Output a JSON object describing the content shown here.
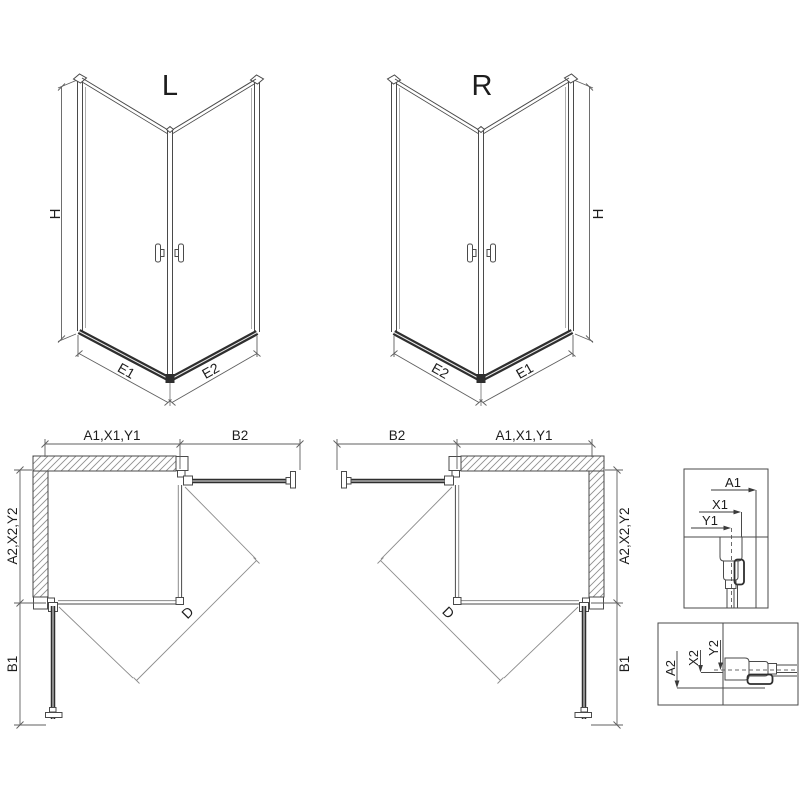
{
  "diagram": {
    "iso_left": {
      "title": "L",
      "h": "H",
      "e1": "E1",
      "e2": "E2"
    },
    "iso_right": {
      "title": "R",
      "h": "H",
      "e1": "E1",
      "e2": "E2"
    },
    "plan_left": {
      "width_label": "A1,X1,Y1",
      "door_top_label": "B2",
      "depth_label": "A2,X2,Y2",
      "door_side_label": "B1",
      "diagonal_label": "D"
    },
    "plan_right": {
      "width_label": "A1,X1,Y1",
      "door_top_label": "B2",
      "depth_label": "A2,X2,Y2",
      "door_side_label": "B1",
      "diagonal_label": "D"
    },
    "detail_top": {
      "a": "A1",
      "x": "X1",
      "y": "Y1"
    },
    "detail_bottom": {
      "a": "A2",
      "x": "X2",
      "y": "Y2"
    },
    "colors": {
      "line": "#4a4a4a",
      "thick": "#2e2e2e",
      "dim": "#5f5f5f",
      "swing": "#8c8c8c",
      "hatch": "#8f8f8f",
      "background": "#ffffff"
    }
  }
}
